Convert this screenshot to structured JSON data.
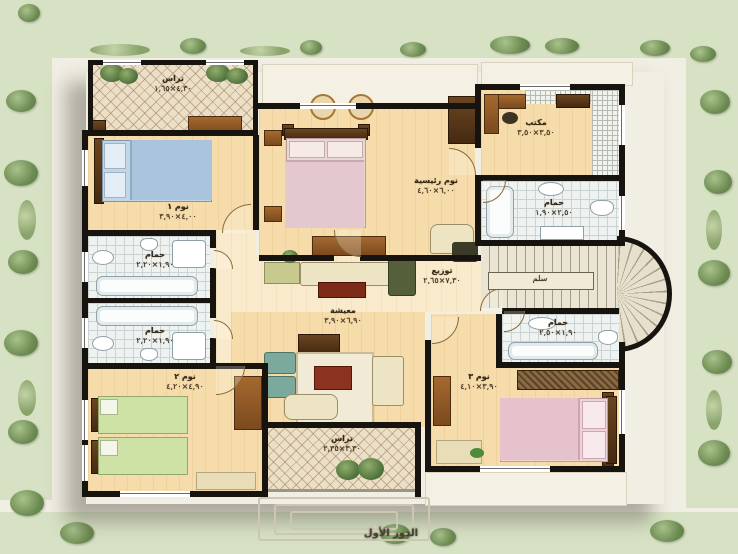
{
  "caption": {
    "text": "الدور الأول"
  },
  "rooms": {
    "terrace_top": {
      "name": "تراس",
      "dims": "٤,٣٠×١,٦٥"
    },
    "bedroom1": {
      "name": "نوم ١",
      "dims": "٤,٠٠×٣,٩٠"
    },
    "master": {
      "name": "نوم رئيسية",
      "dims": "٦,٠٠×٤,٦٠"
    },
    "office": {
      "name": "مكتب",
      "dims": "٣,٥٠×٣,٥٠"
    },
    "bath_top": {
      "name": "حمام",
      "dims": "٢,٥٠×١,٩٠"
    },
    "bath_left1": {
      "name": "حمام",
      "dims": "١,٩٠×٢,٢٠"
    },
    "bath_left2": {
      "name": "حمام",
      "dims": "١,٩٠×٢,٢٠"
    },
    "hall": {
      "name": "توزيع",
      "dims": "٧,٣٠×٢,٦٥"
    },
    "living": {
      "name": "معيشة",
      "dims": "٦,٩٠×٣,٩٠"
    },
    "stair": {
      "name": "سلم"
    },
    "bath_right": {
      "name": "حمام",
      "dims": "١,٩٠×٢,٥٠"
    },
    "bedroom3": {
      "name": "نوم ٣",
      "dims": "٣,٩٠×٤,١٠"
    },
    "bedroom2": {
      "name": "نوم ٢",
      "dims": "٤,٩٠×٤,٢٠"
    },
    "terrace_bottom": {
      "name": "تراس",
      "dims": "٣,٣٠×٢,٣٥"
    }
  },
  "colors": {
    "wall": "#17130e",
    "floor_peach": "#f6dcab",
    "corridor_cream": "#f8eacb",
    "terrace_tile": "#ecdfc8",
    "bath_tile": "#eef2f0",
    "landscape_green": "#d7e2c4",
    "wood_accent": "#8a5a30"
  }
}
